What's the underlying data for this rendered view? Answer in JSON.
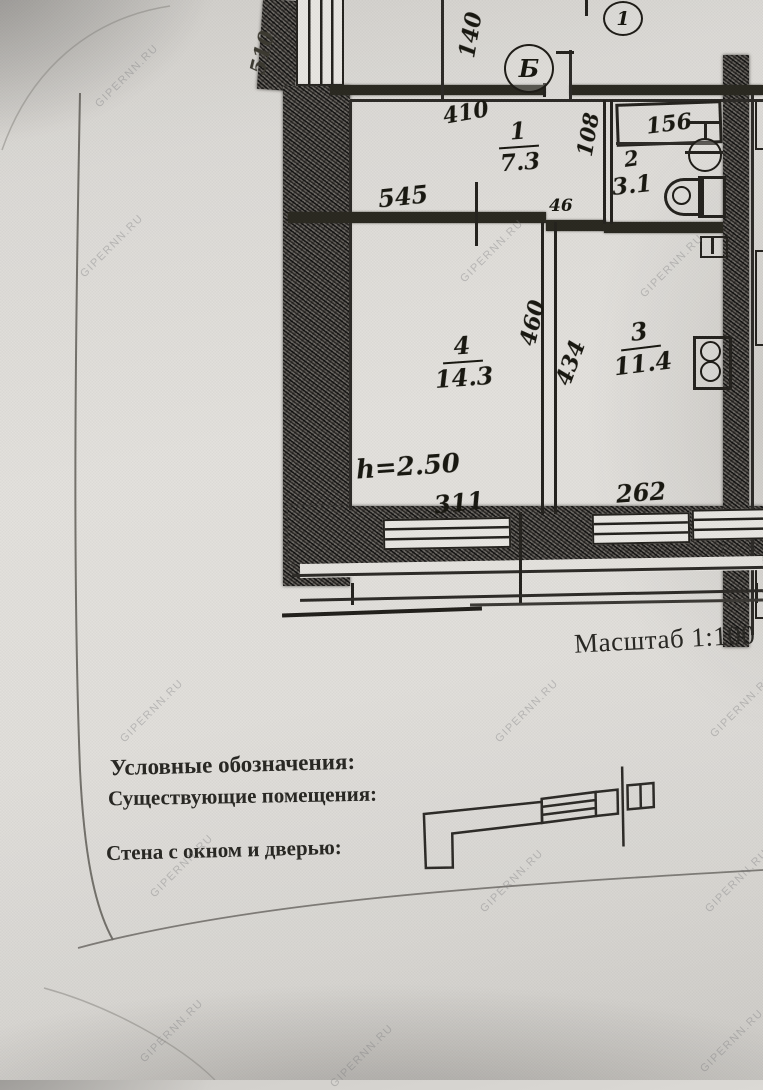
{
  "watermark": {
    "text": "GIPERNN.RU"
  },
  "plan": {
    "scale_label": "Масштаб 1:100",
    "axis": {
      "marker1": "1",
      "marker2": "Б"
    },
    "rooms": {
      "r1": {
        "num": "1",
        "area": "7.3"
      },
      "r2": {
        "num": "2",
        "area": "3.1"
      },
      "r3": {
        "num": "3",
        "area": "11.4"
      },
      "r4": {
        "num": "4",
        "area": "14.3"
      }
    },
    "dims": {
      "wall_left_top": "510",
      "top": "140",
      "room1_width": "410",
      "room1_bottom": "545",
      "hall_width": "108",
      "jog": "46",
      "bath_fixture": "156",
      "room4_right_a": "460",
      "room4_right_b": "434",
      "height_note": "h=2.50",
      "room4_bottom": "311",
      "room3_bottom": "262"
    }
  },
  "legend": {
    "title": "Условные обозначения:",
    "subtitle": "Существующие помещения:",
    "wall_item": "Стена с окном и дверью:"
  }
}
